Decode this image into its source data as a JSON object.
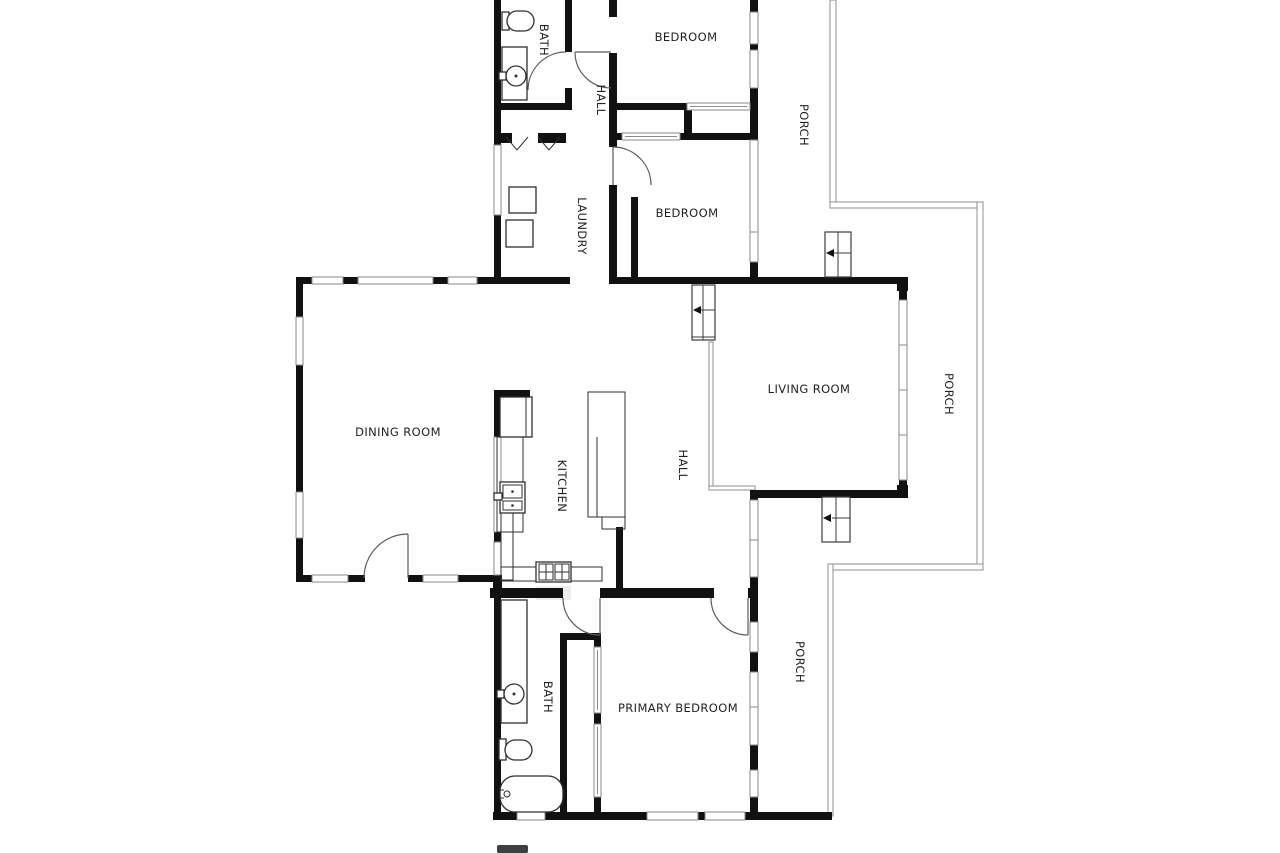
{
  "plan": {
    "background": "#ffffff",
    "wall_color": "#111111",
    "thin_line_color": "#8a8a8a",
    "label_color": "#1f1f1f"
  },
  "rooms": {
    "bath_top": "BATH",
    "hall_top": "HALL",
    "bedroom_top": "BEDROOM",
    "porch_top": "PORCH",
    "laundry": "LAUNDRY",
    "bedroom_middle": "BEDROOM",
    "dining_room": "DINING ROOM",
    "kitchen": "KITCHEN",
    "hall_center": "HALL",
    "living_room": "LIVING ROOM",
    "porch_right": "PORCH",
    "bath_bottom": "BATH",
    "primary_bedroom": "PRIMARY BEDROOM",
    "porch_bottom": "PORCH"
  }
}
